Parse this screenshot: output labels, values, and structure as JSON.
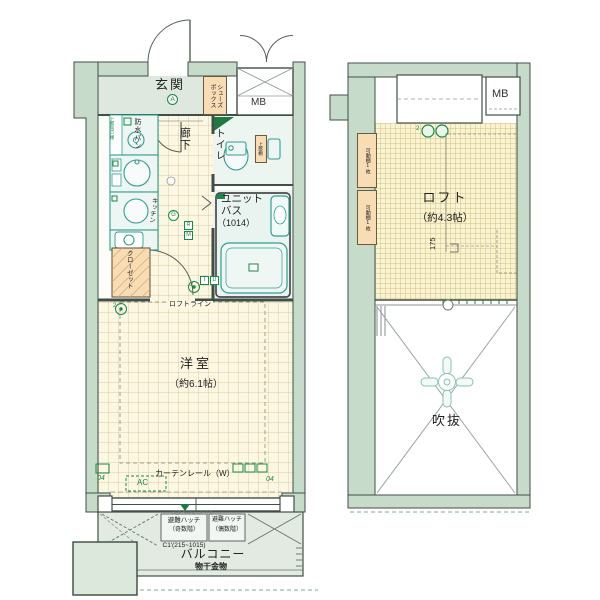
{
  "colors": {
    "wall_fill": "#c7dbcb",
    "wall_line": "#3f4f45",
    "floor_cream": "#fbf7e2",
    "floor_loft": "#f9f3d2",
    "floor_gray": "#dfe8df",
    "fixture_teal": "#2e9e8f",
    "accent_orange": "#f7dcb4",
    "symbol_green": "#178a46"
  },
  "floor_plan": {
    "main": {
      "entrance": {
        "label": "玄関",
        "mark": "A"
      },
      "shoe_box": "シューズ\nボックス",
      "meter_box": "MB",
      "waterproof_pan": "防水パン",
      "upper_cabinet": "上部吊戸棚",
      "hallway": {
        "label": "廊下",
        "mark": "G"
      },
      "toilet": {
        "label": "トイレ",
        "upper_shelf": "上部棚"
      },
      "unit_bath": {
        "line1": "ユニット",
        "line2": "バス",
        "size": "（1014）"
      },
      "kitchen": "キッチン",
      "closet": "クローゼット",
      "loft_line": "ロフトライン",
      "room": {
        "label": "洋室",
        "size": "（約6.1帖）"
      },
      "curtain_rail": "カーテンレール（W）",
      "ac": "AC",
      "outlet_left": "04",
      "outlet_right": "04",
      "high_sash": "High Sash(H=2,110)",
      "hatch_odd": {
        "line1": "避難ハッチ",
        "line2": "（奇数階）",
        "line3": "C1'(215~1015)"
      },
      "hatch_even": {
        "line1": "避難ハッチ",
        "line2": "（偶数階）"
      },
      "balcony": "バルコニー",
      "drying_fixture": "物干金物",
      "markers": {
        "r": "R",
        "m": "M",
        "i": "I",
        "u": "U",
        "two": "2"
      }
    },
    "loft_floor": {
      "meter_box": "MB",
      "movable_shelf_1": "可動棚1枚",
      "movable_shelf_2": "可動棚1枚",
      "loft": {
        "label": "ロフト",
        "size": "（約4.3帖）"
      },
      "dimension": "175",
      "void": "吹抜"
    }
  }
}
